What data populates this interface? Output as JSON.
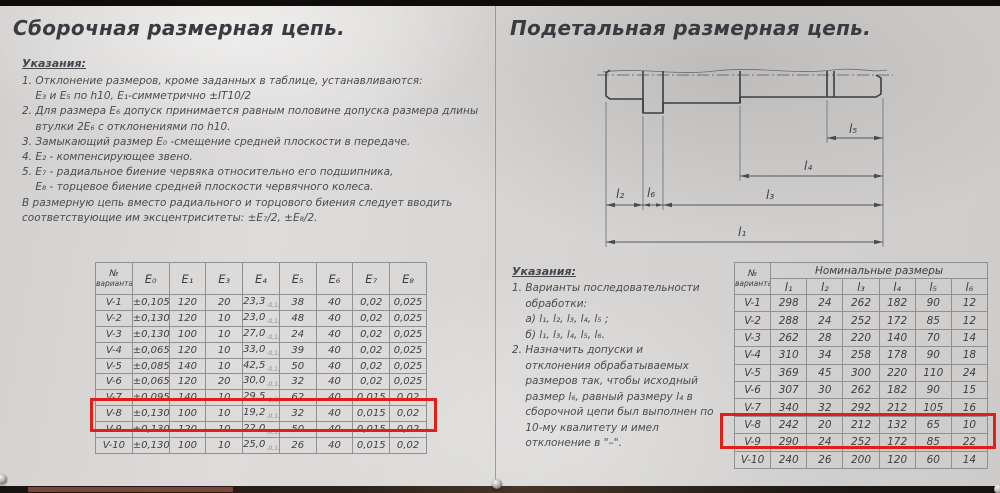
{
  "left": {
    "title": "Сборочная размерная цепь.",
    "notes_heading": "Указания:",
    "notes": [
      "1. Отклонение размеров, кроме заданных в таблице, устанавливаются:",
      "    E₃ и E₅ по h10, E₁-симметрично ±IT10/2",
      "2. Для размера E₆ допуск принимается равным половине допуска размера длины",
      "    втулки 2E₆ с отклонениями по h10.",
      "3. Замыкающий размер E₀ -смещение средней плоскости в передаче.",
      "4. E₂ - компенсирующее звено.",
      "5. E₇ - радиальное биение червяка относительно его подшипника,",
      "    E₈ - торцевое биение средней плоскости червячного колеса.",
      "В размерную цепь вместо радиального и торцового биения следует вводить",
      "соответствующие им эксцентриситеты: ±E₇/2, ±E₈/2."
    ],
    "table": {
      "corner": [
        "№",
        "варианта"
      ],
      "headers": [
        "E₀",
        "E₁",
        "E₃",
        "E₄",
        "E₅",
        "E₆",
        "E₇",
        "E₈"
      ],
      "highlight_row": "V-8",
      "rows": [
        {
          "variant": "V-1",
          "e0": "±0,105",
          "e1": "120",
          "e3": "20",
          "e4": "23,3",
          "e4_sub": "-0,13",
          "e5": "38",
          "e6": "40",
          "e7": "0,02",
          "e8": "0,025"
        },
        {
          "variant": "V-2",
          "e0": "±0,130",
          "e1": "120",
          "e3": "10",
          "e4": "23,0",
          "e4_sub": "-0,13",
          "e5": "48",
          "e6": "40",
          "e7": "0,02",
          "e8": "0,025"
        },
        {
          "variant": "V-3",
          "e0": "±0,130",
          "e1": "100",
          "e3": "10",
          "e4": "27,0",
          "e4_sub": "-0,13",
          "e5": "24",
          "e6": "40",
          "e7": "0,02",
          "e8": "0,025"
        },
        {
          "variant": "V-4",
          "e0": "±0,065",
          "e1": "120",
          "e3": "10",
          "e4": "33,0",
          "e4_sub": "-0,13",
          "e5": "39",
          "e6": "40",
          "e7": "0,02",
          "e8": "0,025"
        },
        {
          "variant": "V-5",
          "e0": "±0,085",
          "e1": "140",
          "e3": "10",
          "e4": "42,5",
          "e4_sub": "-0,13",
          "e5": "50",
          "e6": "40",
          "e7": "0,02",
          "e8": "0,025"
        },
        {
          "variant": "V-6",
          "e0": "±0,065",
          "e1": "120",
          "e3": "20",
          "e4": "30,0",
          "e4_sub": "-0,13",
          "e5": "32",
          "e6": "40",
          "e7": "0,02",
          "e8": "0,025"
        },
        {
          "variant": "V-7",
          "e0": "±0,095",
          "e1": "140",
          "e3": "10",
          "e4": "29,5",
          "e4_sub": "-0,13",
          "e5": "62",
          "e6": "40",
          "e7": "0,015",
          "e8": "0,02"
        },
        {
          "variant": "V-8",
          "e0": "±0,130",
          "e1": "100",
          "e3": "10",
          "e4": "19,2",
          "e4_sub": "-0,13",
          "e5": "32",
          "e6": "40",
          "e7": "0,015",
          "e8": "0,02"
        },
        {
          "variant": "V-9",
          "e0": "±0,130",
          "e1": "120",
          "e3": "10",
          "e4": "22,0",
          "e4_sub": "-0,13",
          "e5": "50",
          "e6": "40",
          "e7": "0,015",
          "e8": "0,02"
        },
        {
          "variant": "V-10",
          "e0": "±0,130",
          "e1": "100",
          "e3": "10",
          "e4": "25,0",
          "e4_sub": "-0,13",
          "e5": "26",
          "e6": "40",
          "e7": "0,015",
          "e8": "0,02"
        }
      ]
    }
  },
  "right": {
    "title": "Подетальная размерная цепь.",
    "drawing": {
      "labels": {
        "l1": "l₁",
        "l2": "l₂",
        "l3": "l₃",
        "l4": "l₄",
        "l5": "l₅",
        "l6": "l₆"
      }
    },
    "notes_heading": "Указания:",
    "notes": [
      "1. Варианты последовательности",
      "    обработки:",
      "    а) l₁, l₂, l₃, l₄, l₅ ;",
      "    б) l₁, l₃, l₄, l₅, l₆.",
      "2. Назначить допуски и",
      "    отклонения обрабатываемых",
      "    размеров так, чтобы исходный",
      "    размер l₆, равный размеру l₄ в",
      "    сборочной цепи был выполнен по",
      "    10-му квалитету и имел",
      "    отклонение в \"–\"."
    ],
    "table": {
      "corner": [
        "№",
        "варианта"
      ],
      "group_header": "Номинальные размеры",
      "col_headers": [
        "l₁",
        "l₂",
        "l₃",
        "l₄",
        "l₅",
        "l₆"
      ],
      "highlight_row": "V-8",
      "rows": [
        {
          "variant": "V-1",
          "values": [
            "298",
            "24",
            "262",
            "182",
            "90",
            "12"
          ]
        },
        {
          "variant": "V-2",
          "values": [
            "288",
            "24",
            "252",
            "172",
            "85",
            "12"
          ]
        },
        {
          "variant": "V-3",
          "values": [
            "262",
            "28",
            "220",
            "140",
            "70",
            "14"
          ]
        },
        {
          "variant": "V-4",
          "values": [
            "310",
            "34",
            "258",
            "178",
            "90",
            "18"
          ]
        },
        {
          "variant": "V-5",
          "values": [
            "369",
            "45",
            "300",
            "220",
            "110",
            "24"
          ]
        },
        {
          "variant": "V-6",
          "values": [
            "307",
            "30",
            "262",
            "182",
            "90",
            "15"
          ]
        },
        {
          "variant": "V-7",
          "values": [
            "340",
            "32",
            "292",
            "212",
            "105",
            "16"
          ]
        },
        {
          "variant": "V-8",
          "values": [
            "242",
            "20",
            "212",
            "132",
            "65",
            "10"
          ]
        },
        {
          "variant": "V-9",
          "values": [
            "290",
            "24",
            "252",
            "172",
            "85",
            "22"
          ]
        },
        {
          "variant": "V-10",
          "values": [
            "240",
            "26",
            "200",
            "120",
            "60",
            "14"
          ]
        }
      ]
    }
  }
}
